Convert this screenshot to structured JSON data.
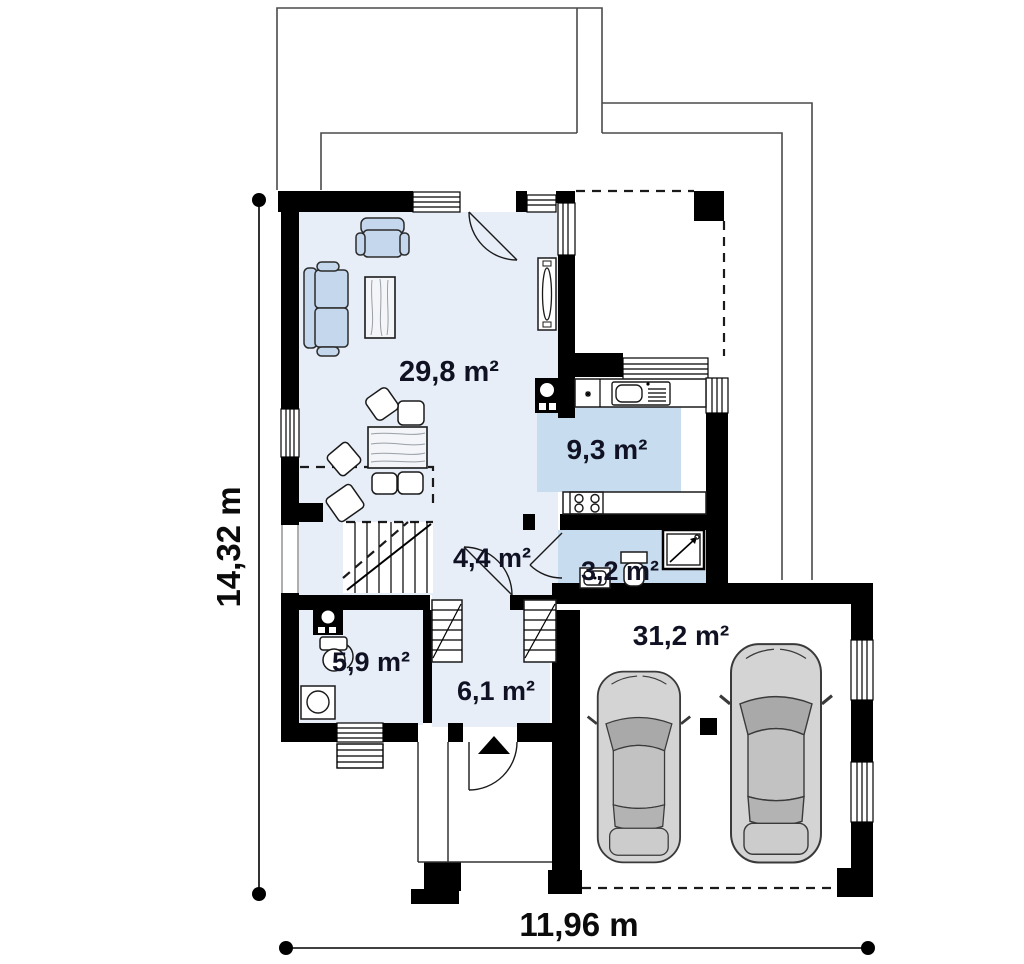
{
  "plan": {
    "type": "floor-plan-ground-floor",
    "colors": {
      "wall": "#000000",
      "floor_light": "#e7eef8",
      "floor_accent": "#c8dcf0",
      "furniture_blue": "#c5d7ed",
      "car_body": "#d4d4d4",
      "overhang_outline": "#4a4a4a",
      "label_text": "#101224"
    }
  },
  "rooms": [
    {
      "name": "living-room",
      "area": "29,8 m²"
    },
    {
      "name": "kitchen",
      "area": "9,3 m²"
    },
    {
      "name": "hallway",
      "area": "4,4 m²"
    },
    {
      "name": "wc",
      "area": "3,2 m²"
    },
    {
      "name": "bathroom-utility",
      "area": "5,9 m²"
    },
    {
      "name": "entry-hall",
      "area": "6,1 m²"
    },
    {
      "name": "garage",
      "area": "31,2 m²"
    }
  ],
  "dimensions": {
    "width": "11,96 m",
    "height": "14,32 m"
  }
}
